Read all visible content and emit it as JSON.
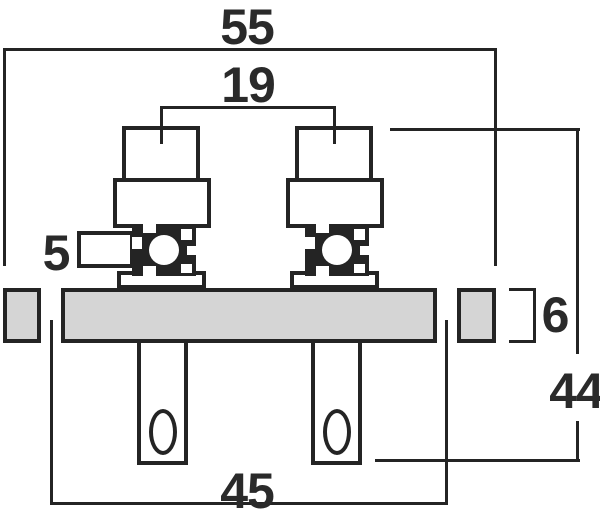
{
  "title": "Technical dimension drawing of dual binding post terminal plate (side view)",
  "units": "mm",
  "colors": {
    "line": "#242424",
    "panel_fill": "#d5d5d5",
    "background": "#ffffff",
    "text": "#2a2a2a"
  },
  "dimensions": {
    "overall_width": "55",
    "post_spacing": "19",
    "side_lug": "5",
    "panel_thickness": "6",
    "overall_height": "44",
    "mounting_hole_spacing": "45"
  }
}
